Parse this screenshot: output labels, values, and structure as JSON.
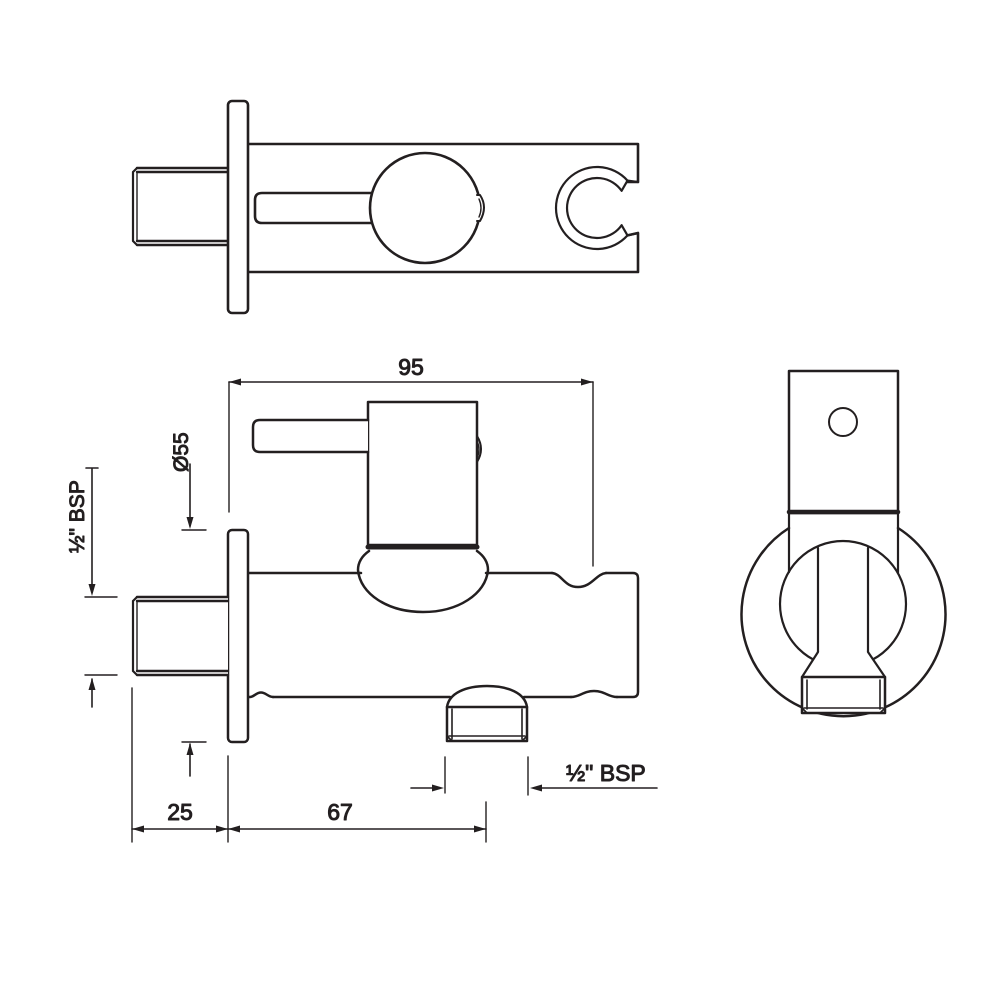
{
  "background": "#ffffff",
  "ink": "#231f20",
  "views": {
    "top": {
      "label": "top-view"
    },
    "front": {
      "label": "front-view"
    },
    "side": {
      "label": "side-view"
    }
  },
  "dimensions": {
    "overall_depth": "95",
    "flange_diameter": "Ø55",
    "inlet_thread": "½\" BSP",
    "wall_clearance": "25",
    "outlet_distance": "67",
    "outlet_thread": "½\" BSP"
  }
}
